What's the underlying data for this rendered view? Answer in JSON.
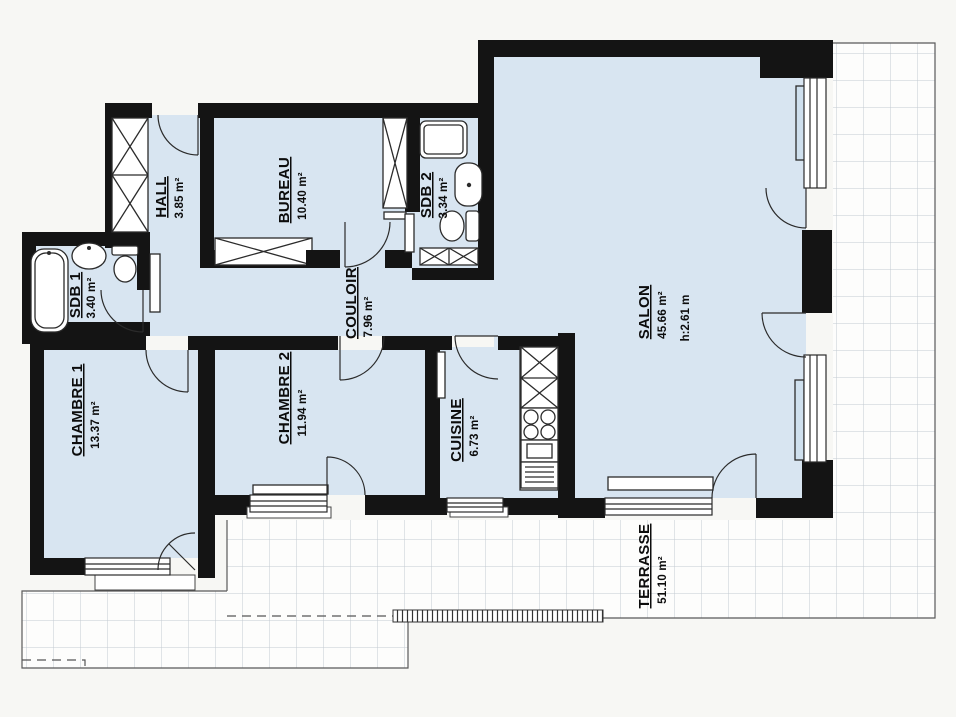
{
  "plan": {
    "type": "apartment-floor-plan",
    "language": "French"
  },
  "rooms": {
    "hall": {
      "name": "HALL",
      "area": "3.85 m²"
    },
    "bureau": {
      "name": "BUREAU",
      "area": "10.40 m²"
    },
    "sdb2": {
      "name": "SDB 2",
      "area": "3.34 m²"
    },
    "sdb1": {
      "name": "SDB 1",
      "area": "3.40 m²"
    },
    "couloir": {
      "name": "COULOIR",
      "area": "7.96 m²"
    },
    "chambre1": {
      "name": "CHAMBRE 1",
      "area": "13.37 m²"
    },
    "chambre2": {
      "name": "CHAMBRE 2",
      "area": "11.94 m²"
    },
    "cuisine": {
      "name": "CUISINE",
      "area": "6.73 m²"
    },
    "salon": {
      "name": "SALON",
      "area": "45.66 m²",
      "height": "h:2.61 m"
    },
    "terrasse": {
      "name": "TERRASSE",
      "area": "51.10 m²"
    }
  },
  "fixtures": [
    "bathtub-icon",
    "shower-icon",
    "washbasin-icon",
    "toilet-icon",
    "wardrobe-icon",
    "kitchen-cabinet-icon",
    "stove-icon",
    "kitchen-sink-icon",
    "dishwasher-icon",
    "radiator-icon",
    "door-swing-icon",
    "window-icon",
    "terrace-tile-grid"
  ],
  "colors": {
    "wall": "#141414",
    "room_fill": "#d8e5f1",
    "terrace_grid": "#c4cad2",
    "background": "#f7f7f4",
    "line": "#2b2b2b"
  }
}
